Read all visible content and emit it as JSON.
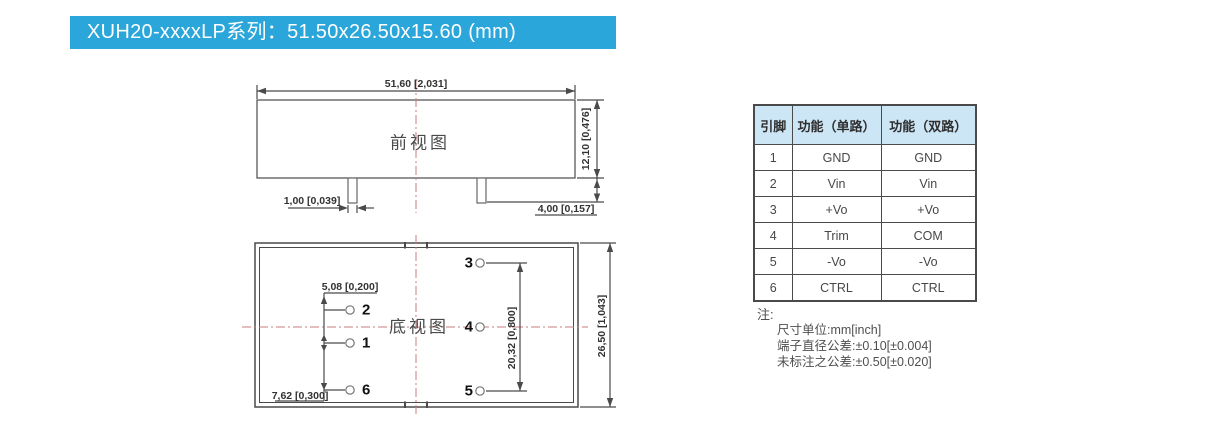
{
  "header": {
    "title": "XUH20-xxxxLP系列：51.50x26.50x15.60 (mm)"
  },
  "front_view": {
    "title": "前视图",
    "dim_width": "51,60 [2,031]",
    "dim_height": "12,10 [0,476]",
    "dim_pin_diameter": "1,00 [0,039]",
    "dim_pin_length": "4,00 [0,157]"
  },
  "bottom_view": {
    "title": "底视图",
    "dim_pin_pitch": "5,08 [0,200]",
    "dim_pin_row_span": "7,62 [0,300]",
    "dim_pin_col_span": "20,32 [0,800]",
    "dim_depth": "26,50 [1,043]",
    "pin_labels": [
      "1",
      "2",
      "3",
      "4",
      "5",
      "6"
    ]
  },
  "pin_table": {
    "headers": [
      "引脚",
      "功能（单路）",
      "功能（双路）"
    ],
    "rows": [
      {
        "pin": "1",
        "single": "GND",
        "dual": "GND"
      },
      {
        "pin": "2",
        "single": "Vin",
        "dual": "Vin"
      },
      {
        "pin": "3",
        "single": "+Vo",
        "dual": "+Vo"
      },
      {
        "pin": "4",
        "single": "Trim",
        "dual": "COM"
      },
      {
        "pin": "5",
        "single": "-Vo",
        "dual": "-Vo"
      },
      {
        "pin": "6",
        "single": "CTRL",
        "dual": "CTRL"
      }
    ]
  },
  "notes": {
    "label": "注:",
    "lines": [
      "尺寸单位:mm[inch]",
      "端子直径公差:±0.10[±0.004]",
      "未标注之公差:±0.50[±0.020]"
    ]
  },
  "colors": {
    "banner_blue": "#2aa6da",
    "table_header_bg": "#cde6f6",
    "centerline_red": "#c97d7d",
    "line_gray": "#4a4a4a"
  }
}
